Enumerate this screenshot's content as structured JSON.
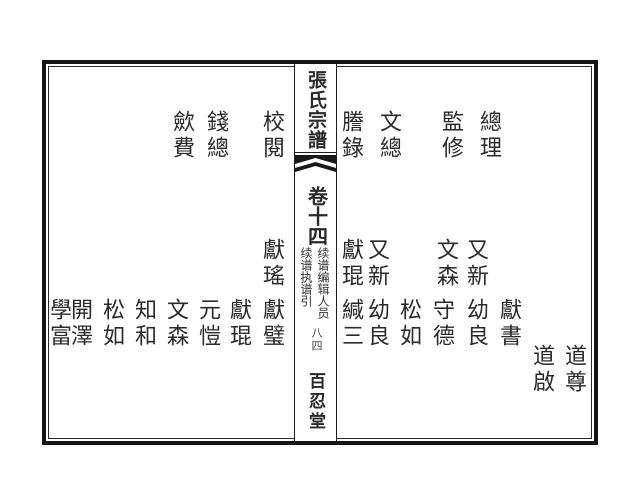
{
  "spine": {
    "title": "張氏宗譜",
    "volume": "卷十四",
    "note_right": "续谱编辑人员",
    "note_left": "续谱执谱引",
    "page_number": "八四",
    "hall": "百忍堂"
  },
  "right_page": {
    "roles": [
      "總理",
      "監修",
      "文總",
      "謄錄"
    ],
    "row_upper": [
      "又新",
      "文森",
      "又新",
      "獻琨"
    ],
    "row_lower": [
      "獻書",
      "幼良",
      "守德",
      "松如",
      "幼良",
      "緘三"
    ],
    "row_bottom": [
      "道尊",
      "道啟"
    ]
  },
  "left_page": {
    "roles": [
      "校閱",
      "錢總",
      "歛費"
    ],
    "row_upper": [
      "獻瑤"
    ],
    "row_lower": [
      "獻璧",
      "獻琨",
      "元愷",
      "文森",
      "知和",
      "松如",
      "開澤",
      "學富"
    ]
  },
  "colors": {
    "ink": "#2a2a2a",
    "border": "#151515",
    "paper": "#ffffff"
  }
}
